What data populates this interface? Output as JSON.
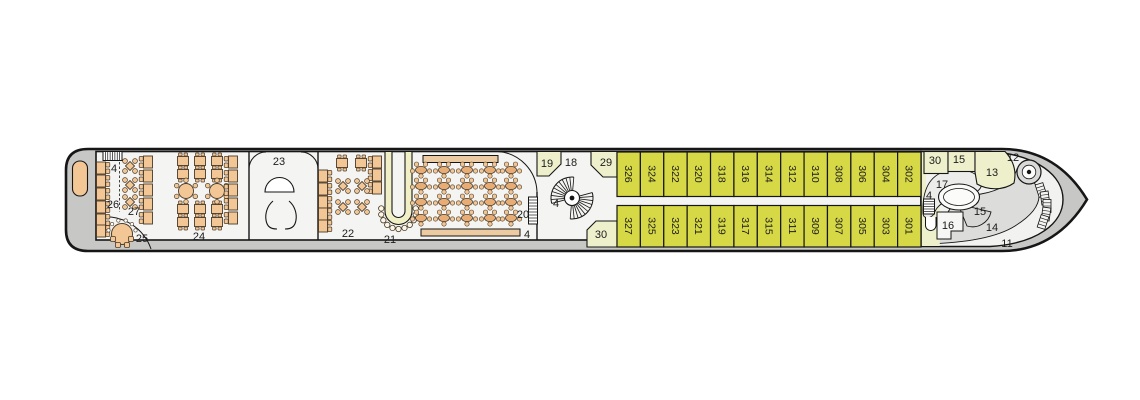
{
  "colors": {
    "outline": "#161616",
    "hull": "#c7c7c5",
    "deck": "#f4f4f2",
    "cabin": "#d6d845",
    "room_pale": "#eef0cb",
    "furniture": "#f2c795",
    "furniture_dark": "#e7ad74",
    "furniture_line": "#4a3a28",
    "bar": "#f0efc6",
    "bench": "#eccaa2",
    "bow_gray": "#dcdcda",
    "bow_light": "#ececea",
    "stool": "#faf7ea"
  },
  "labels": {
    "stairs_aft": "4",
    "stairs_lounge": "4",
    "stairs_spiral": "4",
    "stairs_bow": "4",
    "area11": "11",
    "area12": "12",
    "area13": "13",
    "area14": "14",
    "area15_top": "15",
    "area15_oval": "15",
    "area16": "16",
    "area17": "17",
    "area18": "18",
    "area19": "19",
    "area20": "20",
    "area21": "21",
    "area22": "22",
    "area23": "23",
    "area24": "24",
    "area25": "25",
    "area26": "26",
    "area27": "27",
    "area29": "29",
    "area30_mid": "30",
    "area30_bow": "30"
  },
  "cabins": {
    "top": [
      "326",
      "324",
      "322",
      "320",
      "318",
      "316",
      "314",
      "312",
      "310",
      "308",
      "306",
      "304",
      "302"
    ],
    "bottom": [
      "327",
      "325",
      "323",
      "321",
      "319",
      "317",
      "315",
      "311",
      "309",
      "307",
      "305",
      "303",
      "301"
    ]
  }
}
